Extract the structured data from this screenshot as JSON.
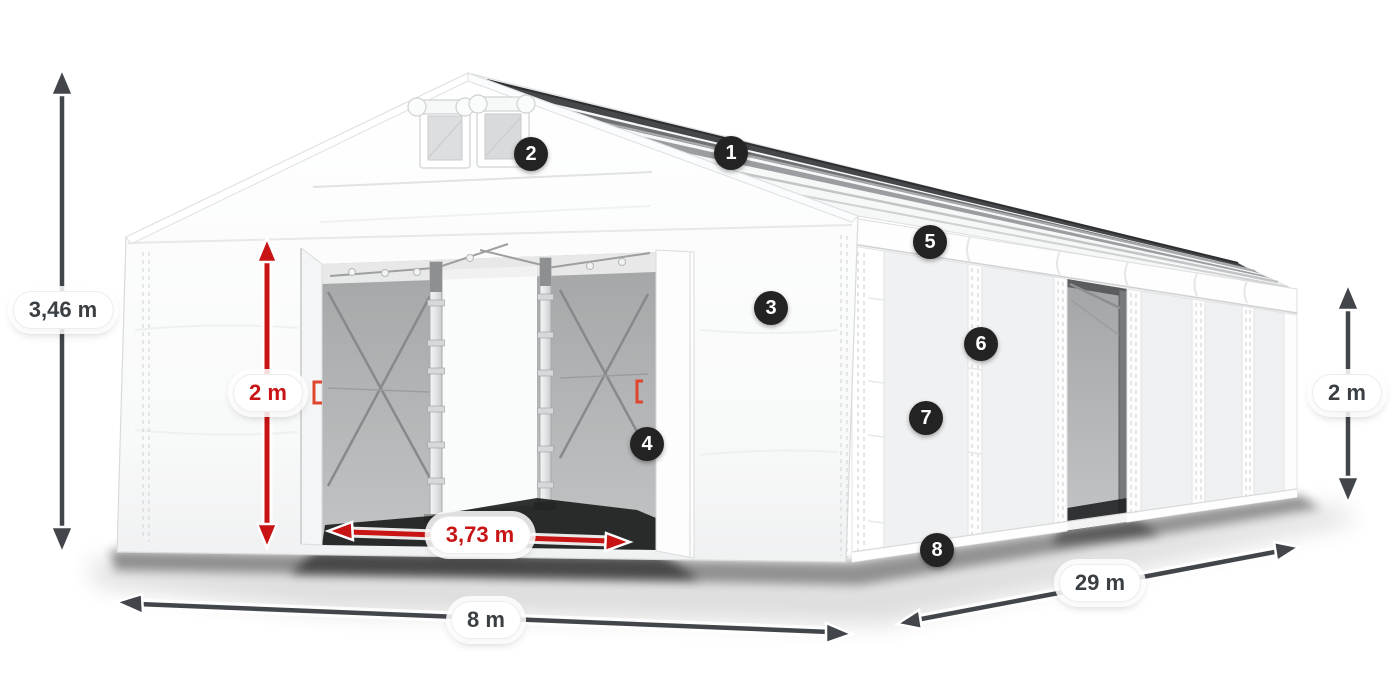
{
  "dimensions": {
    "total_height": {
      "label": "3,46 m"
    },
    "door_height": {
      "label": "2 m"
    },
    "door_width": {
      "label": "3,73 m"
    },
    "front_width": {
      "label": "8 m"
    },
    "length": {
      "label": "29 m"
    },
    "side_wall_height": {
      "label": "2 m"
    }
  },
  "markers": [
    {
      "number": "1"
    },
    {
      "number": "2"
    },
    {
      "number": "3"
    },
    {
      "number": "4"
    },
    {
      "number": "5"
    },
    {
      "number": "6"
    },
    {
      "number": "7"
    },
    {
      "number": "8"
    }
  ],
  "colors": {
    "dimension_red": "#c81414",
    "dimension_dark": "#42464a",
    "marker_background": "#232323",
    "marker_text": "#ffffff",
    "tent_white": "#ffffff",
    "interior_gray": "#b3b5b6"
  }
}
